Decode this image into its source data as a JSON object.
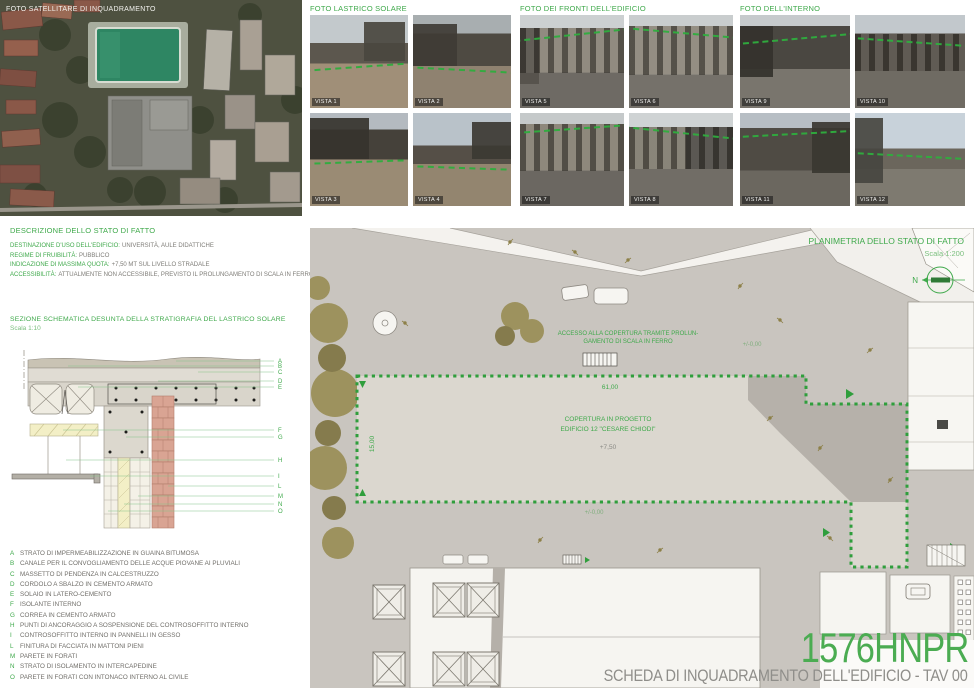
{
  "board": {
    "title_code": "1576HNPR",
    "subtitle": "SCHEDA DI INQUADRAMENTO DELL'EDIFICIO - TAV 00"
  },
  "satellite": {
    "label": "FOTO SATELLITARE DI INQUADRAMENTO"
  },
  "photo_groups": [
    {
      "id": "lastrico",
      "label": "FOTO LASTRICO SOLARE",
      "photos": [
        {
          "label": "VISTA 1",
          "sky": "#c3c9cc",
          "mid": "#5c574e",
          "ground": "#a08f78",
          "skyEnd": 30,
          "midEnd": 52,
          "lineTop": 55,
          "lineRot": -4,
          "win": false,
          "block": {
            "x": 55,
            "y": 8,
            "w": 42,
            "h": 42,
            "c": "#4a463f"
          }
        },
        {
          "label": "VISTA 2",
          "sky": "#a8aeb0",
          "mid": "#4e4a42",
          "ground": "#8f8270",
          "skyEnd": 20,
          "midEnd": 55,
          "lineTop": 58,
          "lineRot": 3,
          "win": false,
          "block": {
            "x": 0,
            "y": 10,
            "w": 45,
            "h": 45,
            "c": "#3f3b35"
          }
        },
        {
          "label": "VISTA 3",
          "sky": "#b4bac0",
          "mid": "#45413a",
          "ground": "#9a8b74",
          "skyEnd": 18,
          "midEnd": 50,
          "lineTop": 52,
          "lineRot": -2,
          "win": false,
          "block": {
            "x": 0,
            "y": 5,
            "w": 60,
            "h": 45,
            "c": "#36332e"
          }
        },
        {
          "label": "VISTA 4",
          "sky": "#b9c2c9",
          "mid": "#554f47",
          "ground": "#93856f",
          "skyEnd": 35,
          "midEnd": 55,
          "lineTop": 58,
          "lineRot": 2,
          "win": false,
          "block": {
            "x": 60,
            "y": 10,
            "w": 40,
            "h": 40,
            "c": "#3c3933"
          }
        }
      ]
    },
    {
      "id": "fronti",
      "label": "FOTO DEI FRONTI DELL'EDIFICIO",
      "photos": [
        {
          "label": "VISTA 5",
          "sky": "#ccd0d1",
          "mid": "#8a8478",
          "ground": "#6e6a64",
          "skyEnd": 14,
          "midEnd": 62,
          "lineTop": 20,
          "lineRot": -6,
          "win": true,
          "block": {
            "x": 0,
            "y": 14,
            "w": 18,
            "h": 60,
            "c": "#55514b"
          }
        },
        {
          "label": "VISTA 6",
          "sky": "#c9cdce",
          "mid": "#8d877b",
          "ground": "#75716a",
          "skyEnd": 12,
          "midEnd": 64,
          "lineTop": 18,
          "lineRot": 5,
          "win": true,
          "block": null
        },
        {
          "label": "VISTA 7",
          "sky": "#c5c9ca",
          "mid": "#878174",
          "ground": "#6b6761",
          "skyEnd": 12,
          "midEnd": 62,
          "lineTop": 16,
          "lineRot": -4,
          "win": true,
          "block": null
        },
        {
          "label": "VISTA 8",
          "sky": "#cfd3d4",
          "mid": "#827d71",
          "ground": "#716d66",
          "skyEnd": 15,
          "midEnd": 60,
          "lineTop": 20,
          "lineRot": 6,
          "win": true,
          "block": {
            "x": 55,
            "y": 15,
            "w": 45,
            "h": 45,
            "c": "#4d4a44"
          }
        }
      ]
    },
    {
      "id": "interno",
      "label": "FOTO DELL'INTERNO",
      "photos": [
        {
          "label": "VISTA 9",
          "sky": "#c6cacc",
          "mid": "#4a4741",
          "ground": "#79756d",
          "skyEnd": 12,
          "midEnd": 58,
          "lineTop": 25,
          "lineRot": -5,
          "win": false,
          "block": {
            "x": 0,
            "y": 12,
            "w": 30,
            "h": 55,
            "c": "#34322d"
          }
        },
        {
          "label": "VISTA 10",
          "sky": "#c2c8cc",
          "mid": "#565149",
          "ground": "#6f6b63",
          "skyEnd": 20,
          "midEnd": 60,
          "lineTop": 28,
          "lineRot": 4,
          "win": true,
          "block": null
        },
        {
          "label": "VISTA 11",
          "sky": "#b7bec4",
          "mid": "#4f4b44",
          "ground": "#6b675f",
          "skyEnd": 16,
          "midEnd": 62,
          "lineTop": 22,
          "lineRot": -3,
          "win": false,
          "block": {
            "x": 65,
            "y": 10,
            "w": 35,
            "h": 55,
            "c": "#3a3731"
          }
        },
        {
          "label": "VISTA 12",
          "sky": "#c8d2da",
          "mid": "#6b665c",
          "ground": "#7e7a70",
          "skyEnd": 38,
          "midEnd": 60,
          "lineTop": 45,
          "lineRot": 3,
          "win": false,
          "block": {
            "x": 0,
            "y": 5,
            "w": 25,
            "h": 70,
            "c": "#474540"
          }
        }
      ]
    }
  ],
  "description": {
    "title": "DESCRIZIONE DELLO STATO DI FATTO",
    "rows": [
      {
        "label": "DESTINAZIONE D'USO DELL'EDIFICIO:",
        "value": "UNIVERSITÀ, AULE DIDATTICHE"
      },
      {
        "label": "REGIME DI FRUIBILITÀ:",
        "value": "PUBBLICO"
      },
      {
        "label": "INDICAZIONE DI MASSIMA QUOTA:",
        "value": "+7,50 MT SUL LIVELLO STRADALE"
      },
      {
        "label": "ACCESSIBILITÀ:",
        "value": "ATTUALMENTE NON ACCESSIBILE, PREVISTO IL PROLUNGAMENTO DI SCALA IN FERRO ESISTENTE"
      }
    ]
  },
  "section": {
    "title": "SEZIONE SCHEMATICA DESUNTA DELLA STRATIGRAFIA DEL LASTRICO SOLARE",
    "scale": "Scala 1:10"
  },
  "legend": {
    "items": [
      {
        "letter": "A",
        "text": "STRATO DI IMPERMEABILIZZAZIONE IN GUAINA BITUMOSA"
      },
      {
        "letter": "B",
        "text": "CANALE PER IL CONVOGLIAMENTO DELLE ACQUE PIOVANE AI PLUVIALI"
      },
      {
        "letter": "C",
        "text": "MASSETTO DI PENDENZA IN CALCESTRUZZO"
      },
      {
        "letter": "D",
        "text": "CORDOLO A SBALZO IN CEMENTO ARMATO"
      },
      {
        "letter": "E",
        "text": "SOLAIO IN LATERO-CEMENTO"
      },
      {
        "letter": "F",
        "text": "ISOLANTE INTERNO"
      },
      {
        "letter": "G",
        "text": "CORREA IN CEMENTO ARMATO"
      },
      {
        "letter": "H",
        "text": "PUNTI DI ANCORAGGIO A SOSPENSIONE DEL CONTROSOFFITTO INTERNO"
      },
      {
        "letter": "I",
        "text": "CONTROSOFFITTO INTERNO IN PANNELLI IN GESSO"
      },
      {
        "letter": "L",
        "text": "FINITURA DI FACCIATA IN MATTONI PIENI"
      },
      {
        "letter": "M",
        "text": "PARETE IN FORATI"
      },
      {
        "letter": "N",
        "text": "STRATO DI ISOLAMENTO IN INTERCAPEDINE"
      },
      {
        "letter": "O",
        "text": "PARETE IN FORATI CON INTONACO INTERNO AL CIVILE"
      }
    ]
  },
  "plan": {
    "title": "PLANIMETRIA DELLO STATO DI FATTO",
    "scale": "Scala 1:200",
    "north_label": "N",
    "annotations": {
      "access_note_line1": "ACCESSO ALLA COPERTURA TRAMITE PROLUN-",
      "access_note_line2": "GAMENTO DI SCALA IN FERRO",
      "roof_label_line1": "COPERTURA IN PROGETTO",
      "roof_label_line2": "EDIFICIO 12 \"CESARE CHIODI\"",
      "roof_elevation": "+7,50",
      "dim_width": "61,00",
      "dim_height": "15,00",
      "street_level_1": "+/-0,00",
      "street_level_2": "+/-0,00"
    }
  },
  "colors": {
    "accent_green": "#3fa94b",
    "outline_green": "#2f9e3c",
    "text_gray": "#7e7c77",
    "plan_bg": "#c9c5bf",
    "roof_fill": "#dbd7cf",
    "shade_gray": "#b6b1aa",
    "paper_white": "#f6f5f1"
  }
}
